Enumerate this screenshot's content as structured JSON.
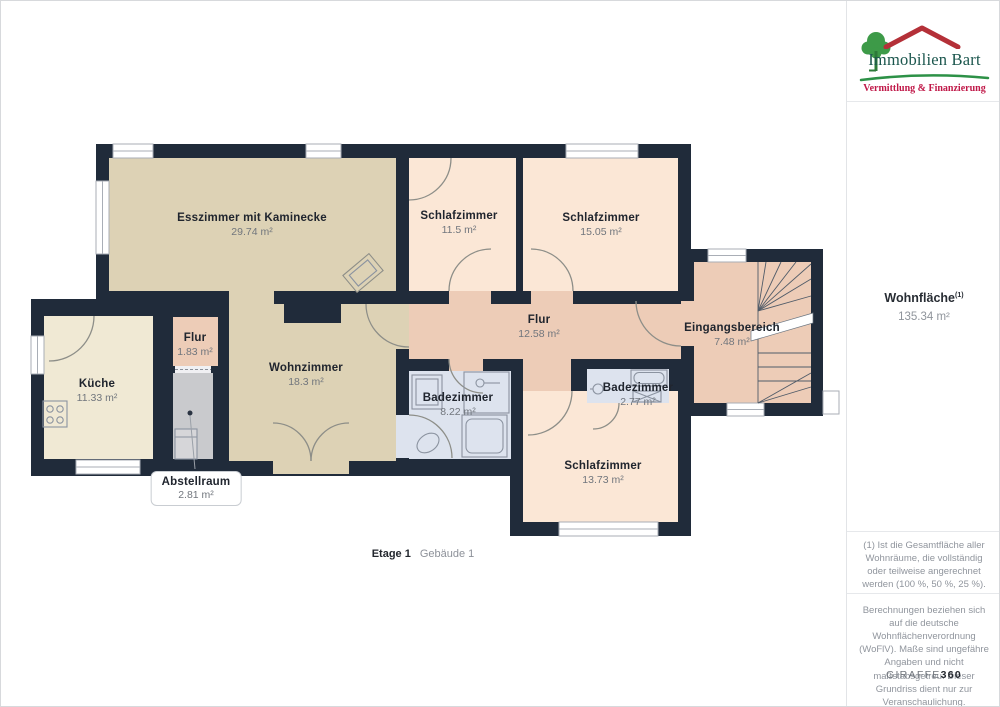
{
  "branding": {
    "name": "Immobilien Bart",
    "tagline": "Vermittlung & Finanzierung",
    "colors": {
      "tree_green": "#3d9a48",
      "roof_red": "#b43038",
      "title_green": "#1b564d",
      "tagline_red": "#c01848",
      "swoosh_green": "#2d9147"
    }
  },
  "sidebar": {
    "area_label": "Wohnfläche",
    "area_sup": "(1)",
    "area_value": "135.34 m²",
    "footnote": "(1) Ist die Gesamtfläche aller Wohnräume, die vollständig oder teilweise angerechnet werden (100 %, 50 %, 25 %).",
    "disclaimer": "Berechnungen beziehen sich auf die deutsche Wohnflächenverordnung (WoFlV). Maße sind ungefähre Angaben und nicht maßstabsgetreu. Dieser Grundriss dient nur zur Veranschaulichung.",
    "brand": "GIRAFFE",
    "brand_suffix": "360"
  },
  "plan": {
    "floor": "Etage 1",
    "building": "Gebäude 1",
    "rooms": [
      {
        "label": "Esszimmer mit Kaminecke",
        "area": "29.74 m²"
      },
      {
        "label": "Schlafzimmer",
        "area": "11.5 m²"
      },
      {
        "label": "Schlafzimmer",
        "area": "15.05 m²"
      },
      {
        "label": "Flur",
        "area": "12.58 m²"
      },
      {
        "label": "Eingangsbereich",
        "area": "7.48 m²"
      },
      {
        "label": "Flur",
        "area": "1.83 m²"
      },
      {
        "label": "Küche",
        "area": "11.33 m²"
      },
      {
        "label": "Wohnzimmer",
        "area": "18.3 m²"
      },
      {
        "label": "Badezimmer",
        "area": "8.22 m²"
      },
      {
        "label": "Badezimmer",
        "area": "2.77 m²"
      },
      {
        "label": "Schlafzimmer",
        "area": "13.73 m²"
      },
      {
        "label": "Abstellraum",
        "area": "2.81 m²"
      }
    ],
    "palette": {
      "wall": "#202b3a",
      "dining_living": "#ddd2b5",
      "kitchen": "#f0e9d4",
      "bedroom": "#fbe7d6",
      "hall": "#edccb7",
      "bath": "#dde3ee",
      "storage": "#c9cacd"
    }
  }
}
